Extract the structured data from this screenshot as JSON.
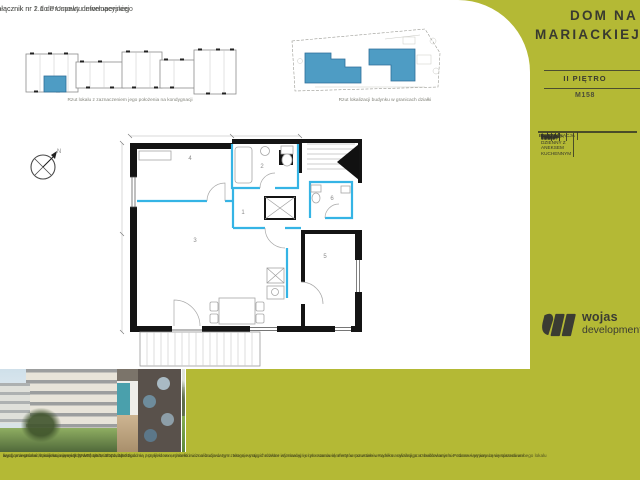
{
  "meta": {
    "attachment_line1": "Załącznik nr 2.1 do Umowy deweloperskiej",
    "attachment_line2": "Załącznik nr 1 do Prospektu informacyjnego"
  },
  "plans": {
    "unit_plan_caption": "Rzut lokalu z zaznaczeniem jego położenia na kondygnacji",
    "site_plan_caption": "Rzut lokalizacji budynku w granicach działki"
  },
  "sidebar": {
    "title_line1": "DOM NA",
    "title_line2": "MARIACKIEJ",
    "floor": "II PIĘTRO",
    "unit_number": "M158",
    "table": {
      "rows": [
        {
          "no": "1.",
          "name": "KOMUNIKACJA",
          "area": "7.64m²"
        },
        {
          "no": "2.",
          "name": "ŁAZIENKA",
          "area": "5.69m²"
        },
        {
          "no": "3.",
          "name": "POKÓJ DZIENNY Z ANEKSEM KUCHENNYM",
          "area": "23.12m²"
        },
        {
          "no": "4.",
          "name": "POKÓJ",
          "area": "13.19m²"
        },
        {
          "no": "5.",
          "name": "POKÓJ",
          "area": "11.45m²"
        },
        {
          "no": "6.",
          "name": "WC",
          "area": "2.08m²"
        }
      ],
      "total_label": "RAZEM",
      "total_area": "63.17m²",
      "balcony_label": "BALKON",
      "balcony_area": "7.35m²"
    },
    "logo_line1": "wojas",
    "logo_line2": "development"
  },
  "floorplan": {
    "room_numbers": {
      "hall": "1",
      "bathroom": "2",
      "living": "3",
      "bedroom1": "4",
      "bedroom2": "5",
      "wc": "6"
    },
    "north_label": "N"
  },
  "legal": {
    "line1": "ary pomieszczeń, lokalizacja przyłączy wodnych, itd. podano zgodnie z projektem architektoniczno-budowlanym. Mogą wystąpić różnice wymiarów i usytuowania elementów powstałe w wyniku realizacji prac budowlanych. Podane wymiary są wymiarami w ś",
    "line2": "wych przegród w stanie surowym. Przedstawione aranżacje lokalu są przykładowe, rysunki i wizualizacje w tym zakresie mają charakter informacyjny i nie stanowią oferty w rozumieniu Kodeksu cywilnego. Umeblowanie nie stanowi wyposażenia sprzedawanego lokalu",
    "line3": "lizacja na stronach projektu elewacji (DWP) 19.04.2021, 18:01"
  },
  "colors": {
    "olive": "#b4b935",
    "accent_blue": "#4e9cc4",
    "plan_cyan": "#35b4e5",
    "charcoal": "#393a2f"
  }
}
